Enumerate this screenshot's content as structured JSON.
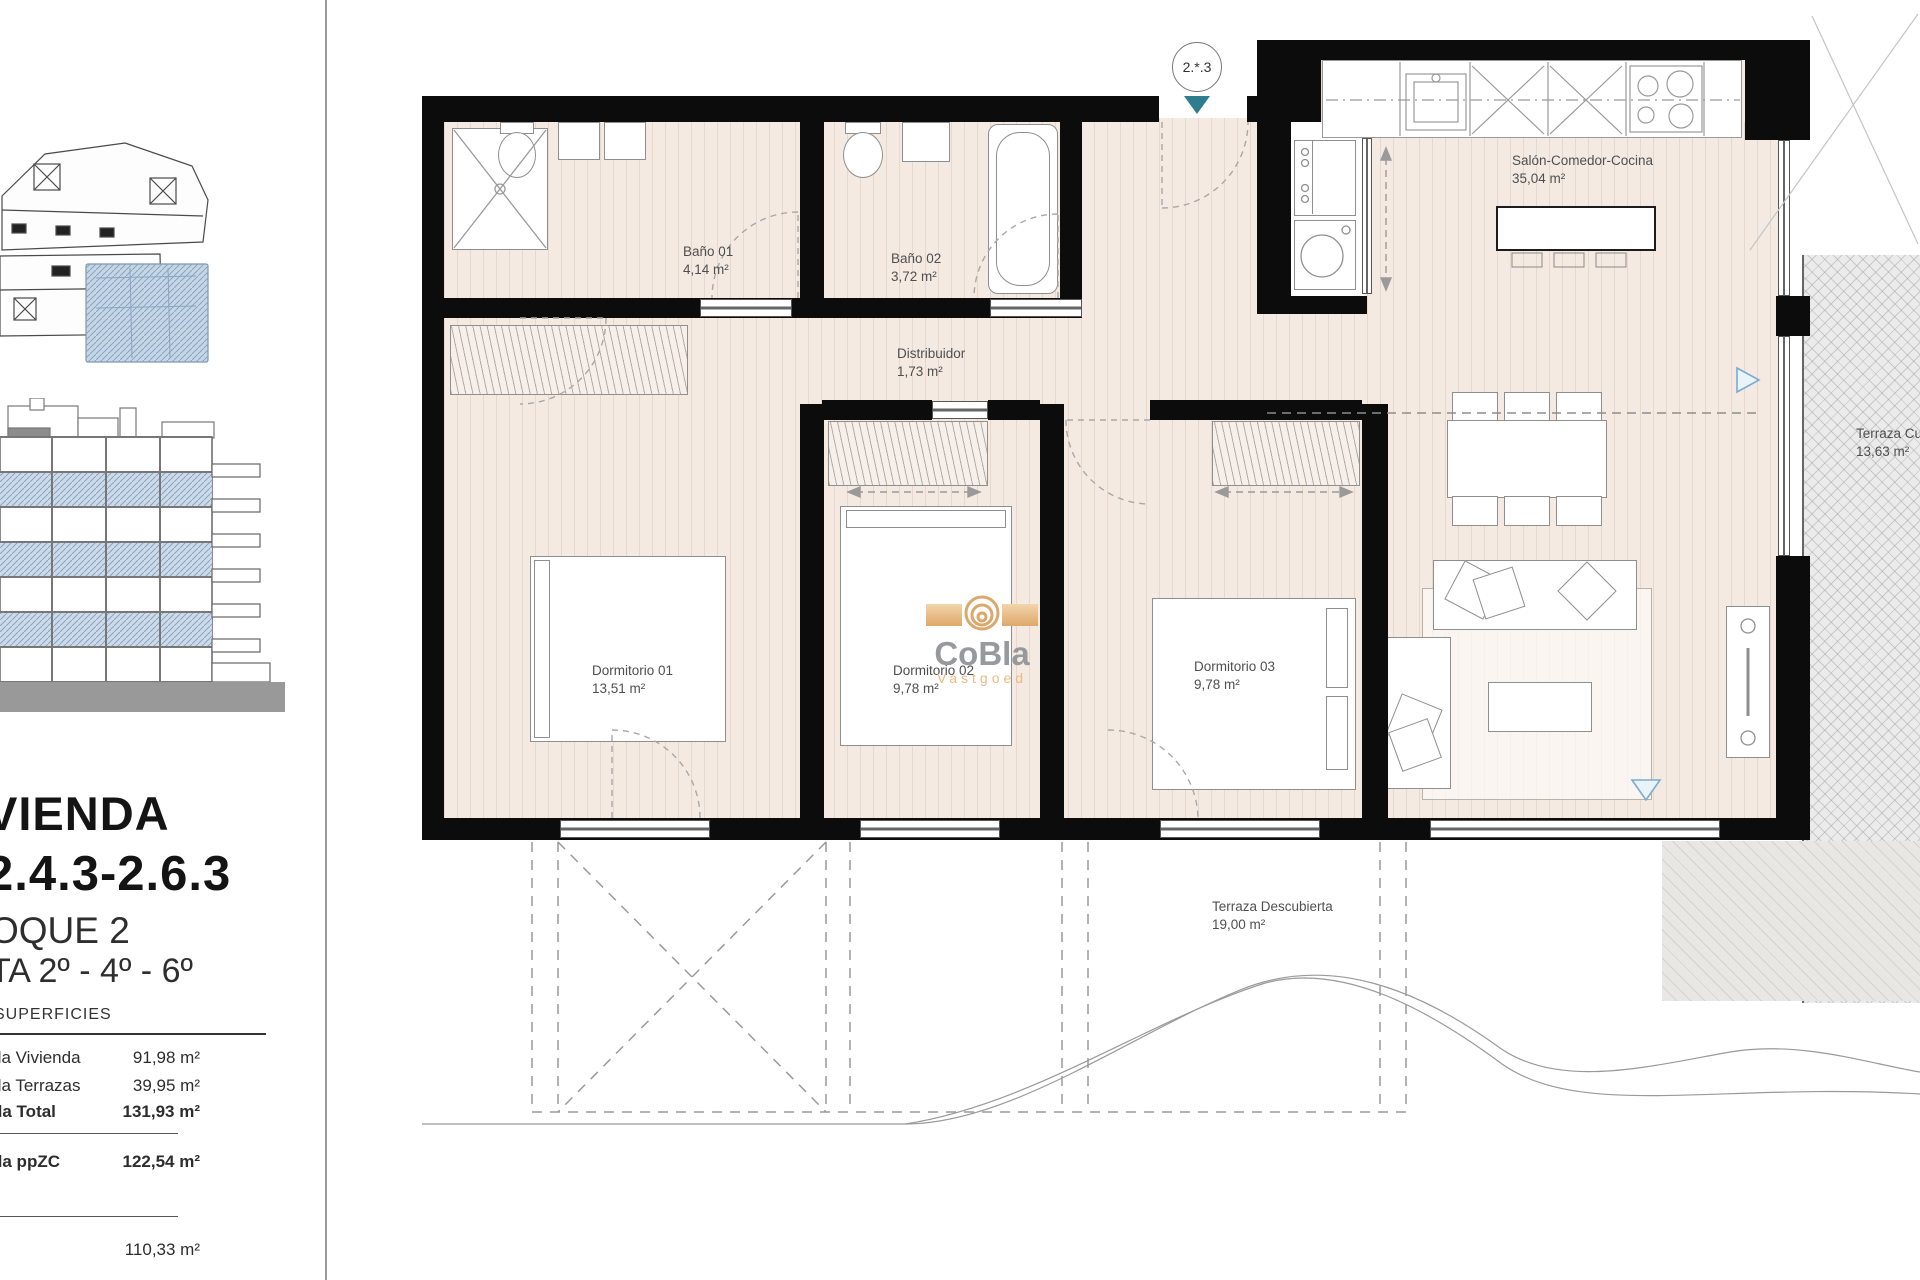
{
  "sidebar": {
    "title_line1": "VIENDA",
    "title_line2": "2.4.3-2.6.3",
    "subtitle_line1": "OQUE 2",
    "subtitle_line2": "TA 2º - 4º - 6º",
    "table_header": "SUPERFICIES",
    "rows": [
      {
        "label": "da Vivienda",
        "value": "91,98 m²"
      },
      {
        "label": "da Terrazas",
        "value": "39,95 m²"
      },
      {
        "label": "da Total",
        "value": "131,93 m²"
      }
    ],
    "row_ppzc": {
      "label": "da ppZC",
      "value": "122,54 m²"
    },
    "row_last": {
      "label": "",
      "value": "110,33 m²"
    }
  },
  "plan": {
    "entrance_tag": "2.*.3",
    "rooms": [
      {
        "name": "Baño 01",
        "area": "4,14 m²"
      },
      {
        "name": "Baño 02",
        "area": "3,72 m²"
      },
      {
        "name": "Distribuidor",
        "area": "1,73 m²"
      },
      {
        "name": "Salón-Comedor-Cocina",
        "area": "35,04 m²"
      },
      {
        "name": "Dormitorio 01",
        "area": "13,51 m²"
      },
      {
        "name": "Dormitorio 02",
        "area": "9,78 m²"
      },
      {
        "name": "Dormitorio 03",
        "area": "9,78 m²"
      },
      {
        "name": "Terraza Cu",
        "area": "13,63 m²"
      },
      {
        "name": "Terraza Descubierta",
        "area": "19,00 m²"
      }
    ]
  },
  "watermark": {
    "line1": "CoBla",
    "line2": "Vastgoed"
  },
  "colors": {
    "accent_teal": "#2e7d8f",
    "blue_hatch": "#ccdae9",
    "tan": "#eec9a0",
    "floor": "#f4eae2"
  }
}
